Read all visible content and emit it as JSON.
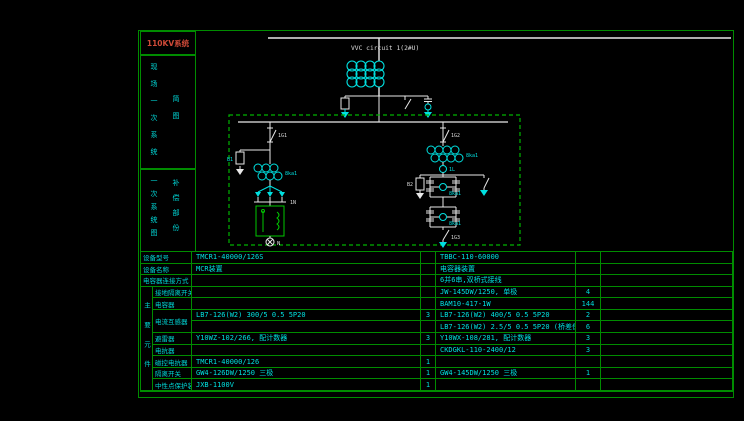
{
  "sidebar": {
    "title": "110KV系统",
    "box1": {
      "main": "现场一次系统",
      "sub": "简图"
    },
    "box2": {
      "main": "一次系统图",
      "sub": "补偿部份"
    }
  },
  "diagram": {
    "bus_label": "VVC circuit 1(2#U)",
    "labels": {
      "left_switch": "1G1",
      "right_switch": "1G2",
      "bottom_switch": "1G3",
      "left_ct": "8ka1",
      "right_ct": "8ka1",
      "bridge_ct1": "8ka1",
      "bridge_ct2": "8ka1",
      "left_arrester": "B1",
      "right_arrester": "B2",
      "junction": "1N",
      "reactor_circle": "1L",
      "neutral": "N"
    },
    "colors": {
      "line": "#e8e8e8",
      "device": "#00e0e0",
      "box": "#00b400"
    }
  },
  "table": {
    "group_label": "主要元件",
    "rows": [
      {
        "label": "设备型号",
        "v1": "TMCR1-40000/126S",
        "q1": "",
        "v2": "TBBC-110-60000",
        "q2": ""
      },
      {
        "label": "设备名称",
        "v1": "MCR装置",
        "q1": "",
        "v2": "电容器装置",
        "q2": ""
      },
      {
        "label": "电容器连接方式",
        "v1": "",
        "q1": "",
        "v2": "6并6串,双桥式接线",
        "q2": ""
      },
      {
        "label": "接地隔离开关",
        "v1": "",
        "q1": "",
        "v2": "JW-145DW/1250, 单极",
        "q2": "4"
      },
      {
        "label": "电容器",
        "v1": "",
        "q1": "",
        "v2": "BAM10-417-1W",
        "q2": "144"
      },
      {
        "label": "电流互感器",
        "v1": "LB7-126(W2) 300/5 0.5 5P20",
        "q1": "3",
        "v2": "LB7-126(W2) 400/5 0.5 5P20",
        "q2": "2"
      },
      {
        "label": "",
        "v1": "",
        "q1": "",
        "v2": "LB7-126(W2) 2.5/5 0.5 5P20 (桥差保护)",
        "q2": "6"
      },
      {
        "label": "避雷器",
        "v1": "Y10WZ-102/266, 配计数器",
        "q1": "3",
        "v2": "Y10WX-108/281, 配计数器",
        "q2": "3"
      },
      {
        "label": "电抗器",
        "v1": "",
        "q1": "",
        "v2": "CKDGKL-110-2400/12",
        "q2": "3"
      },
      {
        "label": "磁控电抗器",
        "v1": "TMCR1-40000/126",
        "q1": "1",
        "v2": "",
        "q2": ""
      },
      {
        "label": "隔离开关",
        "v1": "GW4-126DW/1250 三极",
        "q1": "1",
        "v2": "GW4-145DW/1250 三极",
        "q2": "1"
      },
      {
        "label": "中性点保护装置",
        "v1": "JXB-1100V",
        "q1": "1",
        "v2": "",
        "q2": ""
      }
    ]
  }
}
